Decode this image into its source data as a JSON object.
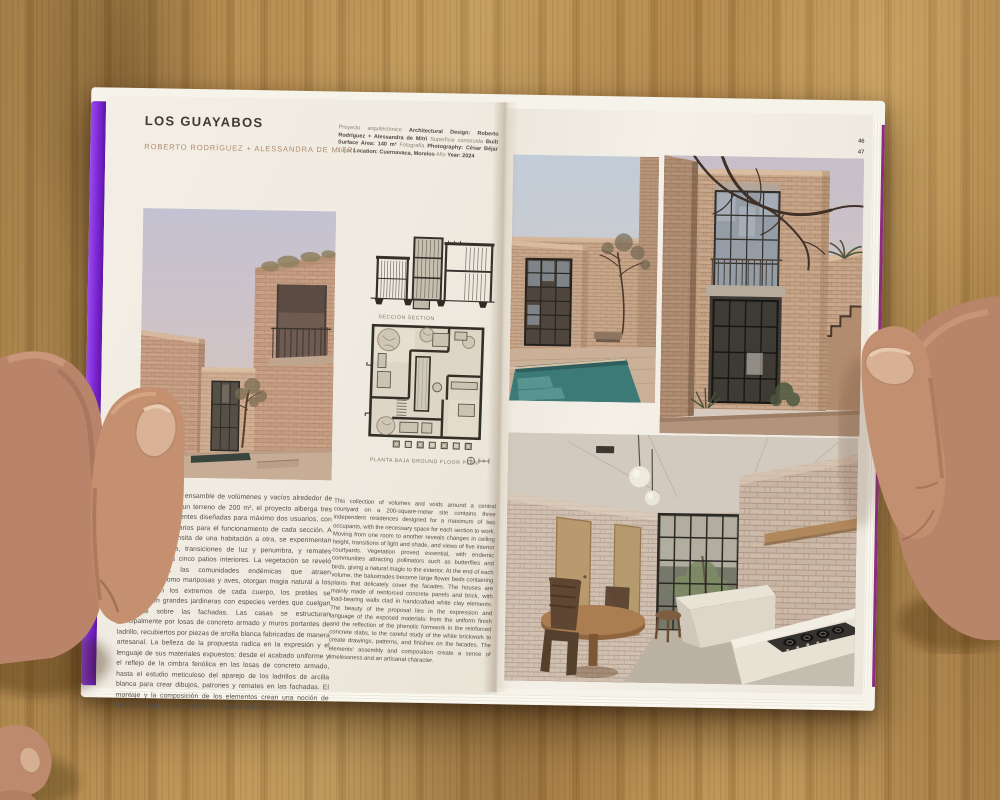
{
  "left_page": {
    "title": "LOS GUAYABOS",
    "authors": "ROBERTO RODRÍGUEZ + ALESSANDRA DE MITRI",
    "credits": [
      {
        "light": "Proyecto arquitectónico",
        "bold": "Architectural Design: Roberto Rodríguez + Alessandra de Mitri"
      },
      {
        "light": "Superficie construida",
        "bold": "Built Surface Area: 140 m²"
      },
      {
        "light": "Fotografía",
        "bold": "Photography: César Béjar"
      },
      {
        "light": "Lugar",
        "bold": "Location: Cuernavaca, Morelos"
      },
      {
        "light": "Año",
        "bold": "Year: 2024"
      }
    ],
    "section_label": "SECCIÓN  SECTION",
    "plan_label": "PLANTA BAJA  GROUND FLOOR PLAN",
    "body_es": "Concebido como un ensamble de volúmenes y vacíos alrededor de un patio central en un terreno de 200 m², el proyecto alberga tres viviendas independientes diseñadas para máximo dos usuarios, con los espacios necesarios para el funcionamiento de cada sección. A medida que se transita de una habitación a otra, se experimentan cambios de altura, transiciones de luz y penumbra, y remates visuales hacia los cinco patios interiores. La vegetación se reveló como esencial; las comunidades endémicas que atraen polinizadores, como mariposas y aves, otorgan magia natural a los exteriores. En los extremos de cada cuerpo, los pretiles se convierten en grandes jardineras con especies verdes que cuelgan sutilmente sobre las fachadas. Las casas se estructuran principalmente por losas de concreto armado y muros portantes de ladrillo, recubiertos por piezas de arcilla blanca fabricadas de manera artesanal. La belleza de la propuesta radica en la expresión y el lenguaje de sus materiales expuestos: desde el acabado uniforme y el reflejo de la cimbra fenólica en las losas de concreto armado, hasta el estudio meticuloso del aparejo de los ladrillos de arcilla blanca para crear dibujos, patrones y remates en las fachadas. El montaje y la composición de los elementos crean una noción de atemporalidad y proporcionan un carácter artesanal.",
    "body_en": "This collection of volumes and voids around a central courtyard on a 200-square-meter site contains three independent residences designed for a maximum of two occupants, with the necessary space for each section to work. Moving from one room to another reveals changes in ceiling height, transitions of light and shade, and views of five interior courtyards. Vegetation proved essential, with endemic communities attracting pollinators such as butterflies and birds, giving a natural magic to the exterior. At the end of each volume, the balustrades become large flower beds containing plants that delicately cover the facades. The houses are mainly made of reinforced concrete panels and brick, with load-bearing walls clad in handcrafted white clay elements. The beauty of the proposal lies in the expression and language of the exposed materials: from the uniform finish and the reflection of the phenolic formwork in the reinforced concrete slabs, to the careful study of the white brickwork to create drawings, patterns, and finishes on the facades. The elements' assembly and composition create a sense of timelessness and an artisanal character."
  },
  "right_page": {
    "page_numbers": [
      "46",
      "47"
    ]
  },
  "photos": {
    "left": "brick courtyard exterior at dusk",
    "top_left": "courtyard with plunge pool and steel window",
    "top_right": "two-story brick tower with gridded windows and bare branches",
    "bottom": "interior kitchen and dining with white brick walls"
  },
  "colors": {
    "cover_purple": "#7c27d4",
    "cover_edge_magenta": "#8d2b7e",
    "page_cream": "#f1ece2",
    "brick_tan": "#c6a48a",
    "pool_teal": "#3c7a77",
    "wood_table": "#b08a52",
    "skin_tone": "#bd8a6e"
  }
}
